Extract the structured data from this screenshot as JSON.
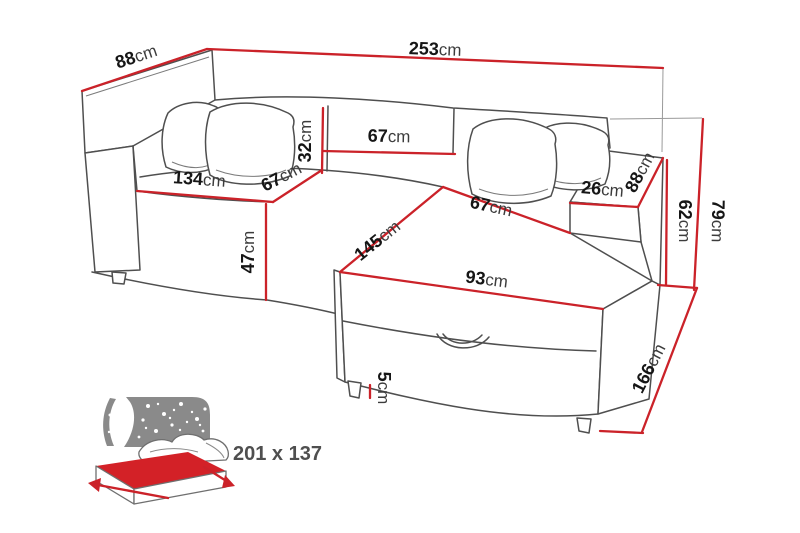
{
  "page": {
    "background": "#ffffff",
    "description": "Corner sofa bed dimension diagram with sleeping-area icon"
  },
  "colors": {
    "dimension_line": "#cb2229",
    "outline": "#4f4f4f",
    "value_text": "#161616",
    "unit_text": "#3c3c3c",
    "icon_gray": "#8a8a8a",
    "icon_text": "#4f4f4f",
    "mattress_red": "#d32127"
  },
  "dimensions": {
    "total_width": {
      "value": "253",
      "unit": "cm"
    },
    "depth_left": {
      "value": "88",
      "unit": "cm"
    },
    "backrest_height": {
      "value": "32",
      "unit": "cm"
    },
    "backrest_section_width": {
      "value": "67",
      "unit": "cm"
    },
    "seat_front_width": {
      "value": "134",
      "unit": "cm"
    },
    "seat_depth": {
      "value": "67",
      "unit": "cm"
    },
    "seat_height": {
      "value": "47",
      "unit": "cm"
    },
    "chaise_length": {
      "value": "145",
      "unit": "cm"
    },
    "chaise_seat_width": {
      "value": "67",
      "unit": "cm"
    },
    "chaise_front_width": {
      "value": "93",
      "unit": "cm"
    },
    "armrest_width": {
      "value": "26",
      "unit": "cm"
    },
    "armrest_depth": {
      "value": "88",
      "unit": "cm"
    },
    "armrest_height": {
      "value": "62",
      "unit": "cm"
    },
    "total_height": {
      "value": "79",
      "unit": "cm"
    },
    "total_depth_right": {
      "value": "166",
      "unit": "cm"
    },
    "leg_height": {
      "value": "5",
      "unit": "cm"
    }
  },
  "sleeping_area": {
    "size_label": "201 x 137"
  }
}
